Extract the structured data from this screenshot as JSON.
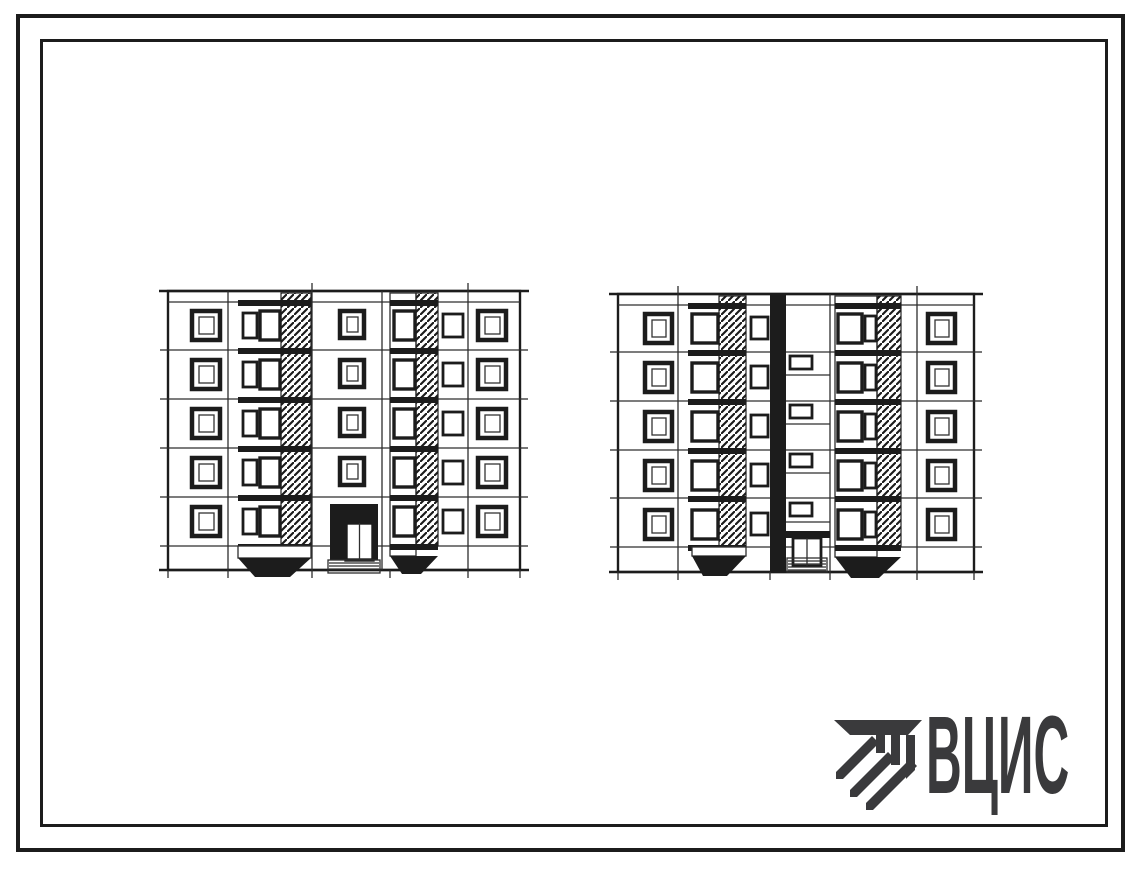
{
  "page": {
    "background": "#ffffff",
    "ink": "#1c1c1c",
    "frame_color": "#111111"
  },
  "logo": {
    "text": "ВЦИС",
    "color": "#3a3a3c",
    "icon_name": "striped-beam-emblem"
  },
  "drawing": {
    "description": "Two hand-drawn end elevations of a five-storey large-panel residential building section",
    "elevations": [
      {
        "id": "left",
        "storeys": 5,
        "window_rows": 5,
        "loggia_stacks": 2,
        "has_entrance_porch": true,
        "has_stairwell_glazing_strip": false
      },
      {
        "id": "right",
        "storeys": 5,
        "window_rows": 5,
        "loggia_stacks": 2,
        "has_entrance_porch": true,
        "has_stairwell_glazing_strip": true
      }
    ]
  }
}
